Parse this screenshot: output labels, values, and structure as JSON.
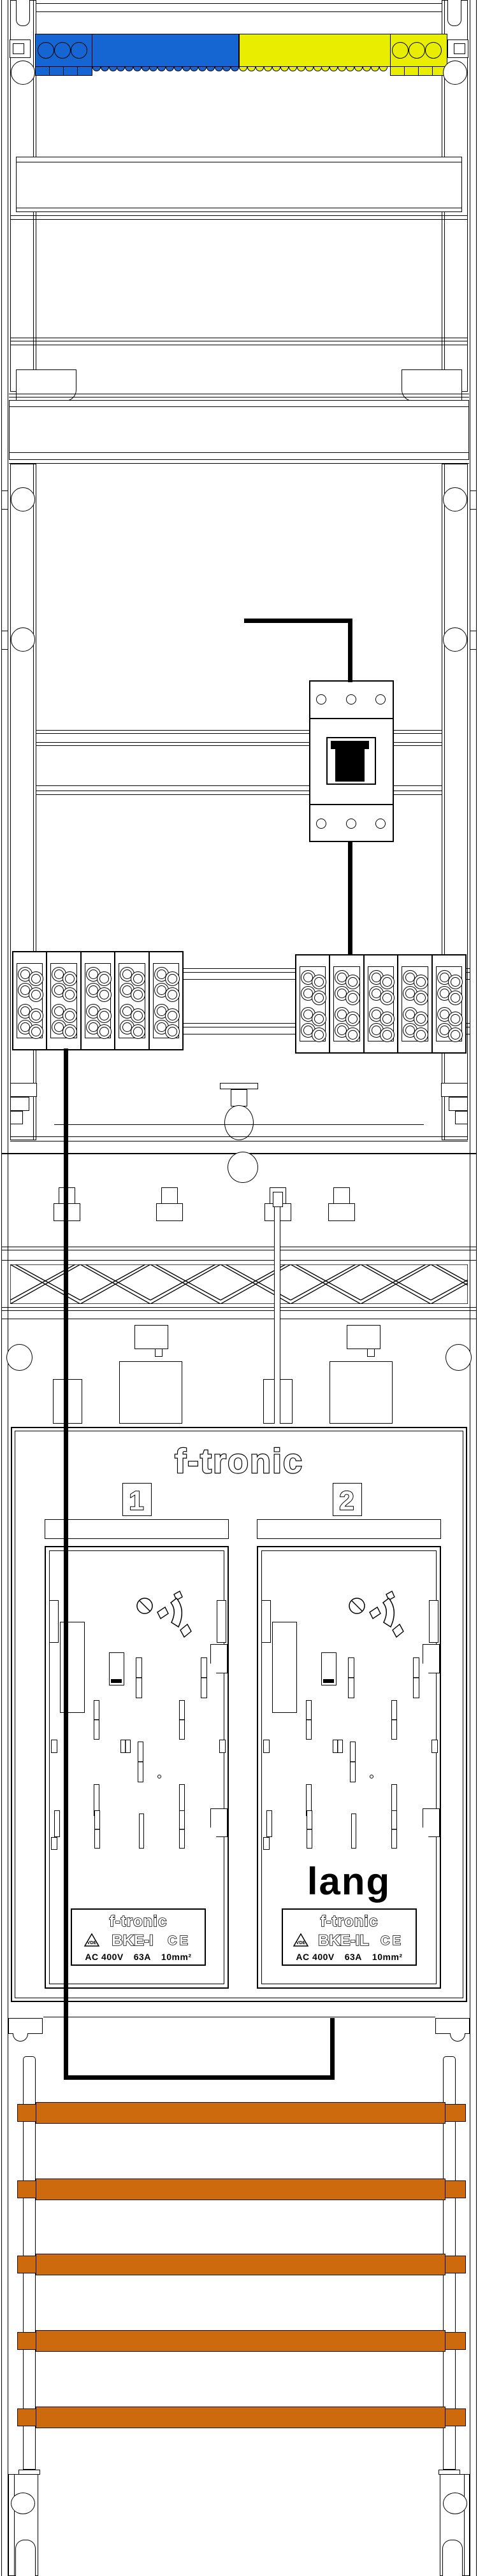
{
  "cabinet": {
    "brand_header": "f-tronic",
    "position_badges": [
      "1",
      "2"
    ],
    "fields": [
      {
        "badge": "1",
        "note": "",
        "plate": {
          "brand": "f-tronic",
          "vde_mark": "VDE",
          "model": "BKE-I",
          "ce_mark": "CE",
          "rating_voltage": "AC 400V",
          "rating_current": "63A",
          "rating_cross_section": "10mm²"
        }
      },
      {
        "badge": "2",
        "note": "lang",
        "plate": {
          "brand": "f-tronic",
          "vde_mark": "VDE",
          "model": "BKE-IL",
          "ce_mark": "CE",
          "rating_voltage": "AC 400V",
          "rating_current": "63A",
          "rating_cross_section": "10mm²"
        }
      }
    ]
  },
  "colors": {
    "neutral_bar_blue": "#1566d2",
    "pe_bar_yellow": "#e9ee00",
    "phase_busbar_orange": "#cd6a0e",
    "wire_black": "#000000"
  }
}
